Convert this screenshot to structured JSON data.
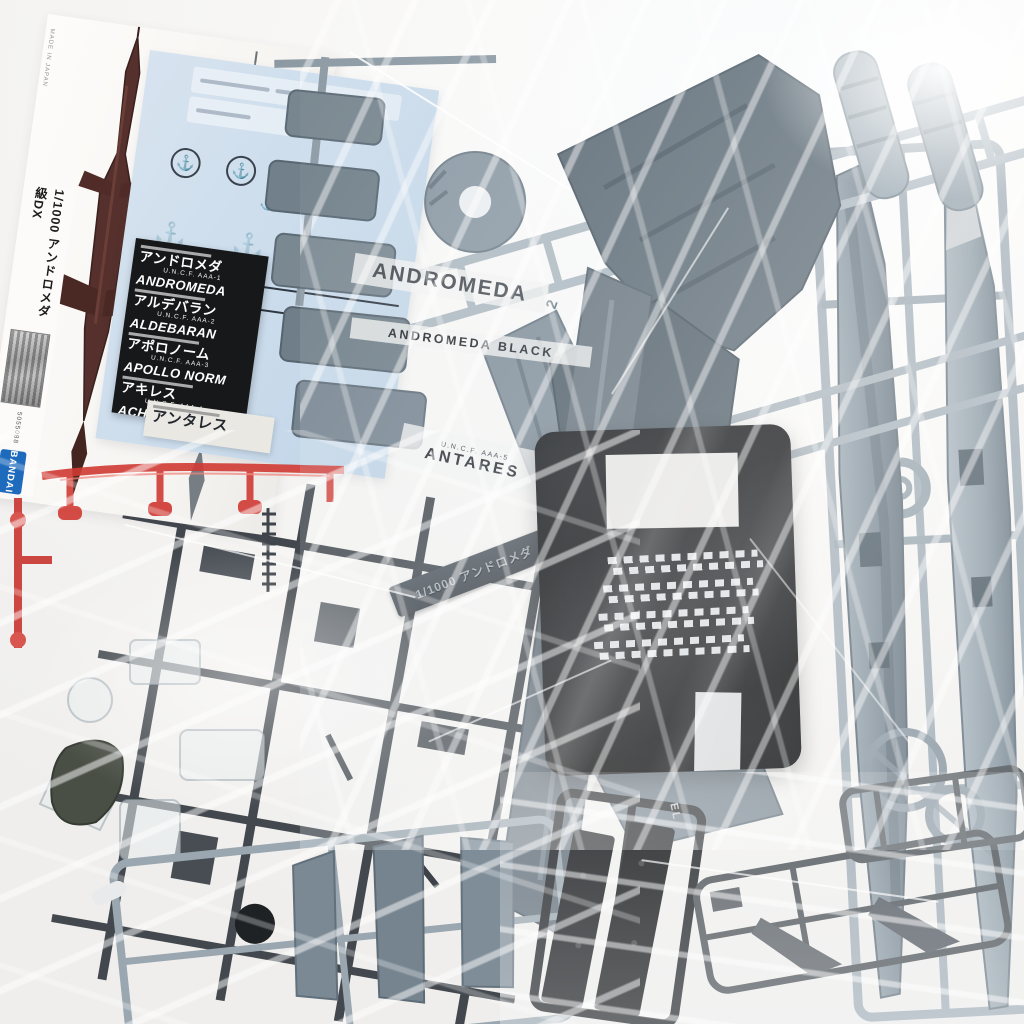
{
  "kit": {
    "spine_title": "1/1000 アンドロメダ級DX",
    "spine_code": "5055088",
    "brand": "BANDAI",
    "side_print": "MADE IN JAPAN"
  },
  "decal_sheet": {
    "ship_names": [
      "ALDEBARAN",
      "ALDEBARAN"
    ]
  },
  "label_sheet": {
    "entries": [
      {
        "jp": "アンドロメダ",
        "reg": "U.N.C.F. AAA-1",
        "en": "ANDROMEDA"
      },
      {
        "jp": "アルデバラン",
        "reg": "U.N.C.F. AAA-2",
        "en": "ALDEBARAN"
      },
      {
        "jp": "アポロノーム",
        "reg": "U.N.C.F. AAA-3",
        "en": "APOLLO NORM"
      },
      {
        "jp": "アキレス",
        "reg": "U.N.C.F. AAA-4",
        "en": "ACHILLES"
      }
    ],
    "extra_entry_jp": "アンタレス"
  },
  "visible_stickers": {
    "andromeda": "ANDROMEDA",
    "andromeda_black": "ANDROMEDA BLACK",
    "antares_reg": "U.N.C.F. AAA-5",
    "antares": "ANTARES"
  },
  "nameplate": {
    "text": "1/1000 アンドロメダ"
  },
  "sprue_marks": {
    "runner_number": "2",
    "black_runner_mark": "EL"
  },
  "colors": {
    "background": "#f5f4f2",
    "plastic_blue_gray": "#8d9aa5",
    "plastic_dark_deck": "#5a6872",
    "plastic_dark_gray": "#42484e",
    "plastic_black": "#141518",
    "clear_red_runner": "#d13a34",
    "decal_sheet_blue": "#cfdeeb",
    "label_sheet_black": "#17181a",
    "bandai_blue": "#1e6bbd",
    "ship_illustration_red": "#55302c",
    "ship_illustration_gray": "#868d93"
  }
}
